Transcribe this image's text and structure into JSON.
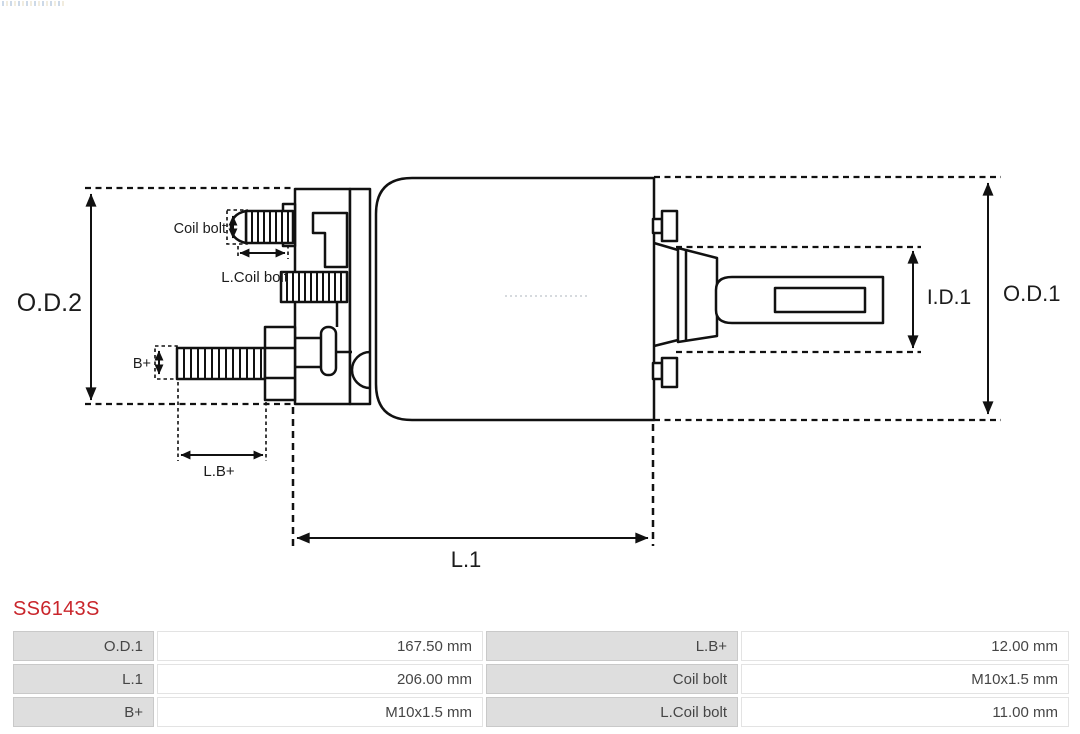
{
  "part_number": "SS6143S",
  "diagram": {
    "labels": {
      "od2": "O.D.2",
      "coil_bolt": "Coil bolt",
      "l_coil_bolt": "L.Coil bolt",
      "b_plus": "B+",
      "l_b_plus": "L.B+",
      "l1": "L.1",
      "id1": "I.D.1",
      "od1": "O.D.1"
    }
  },
  "specs_table": {
    "rows": [
      [
        "O.D.1",
        "167.50 mm",
        "L.B+",
        "12.00 mm"
      ],
      [
        "L.1",
        "206.00 mm",
        "Coil bolt",
        "M10x1.5 mm"
      ],
      [
        "B+",
        "M10x1.5 mm",
        "L.Coil bolt",
        "11.00 mm"
      ]
    ]
  },
  "colors": {
    "drawing_line": "#111111",
    "part_number_red": "#c9252b",
    "label_cell_bg": "#dedede",
    "cell_border": "#c9c9c9",
    "table_text": "#454545"
  }
}
